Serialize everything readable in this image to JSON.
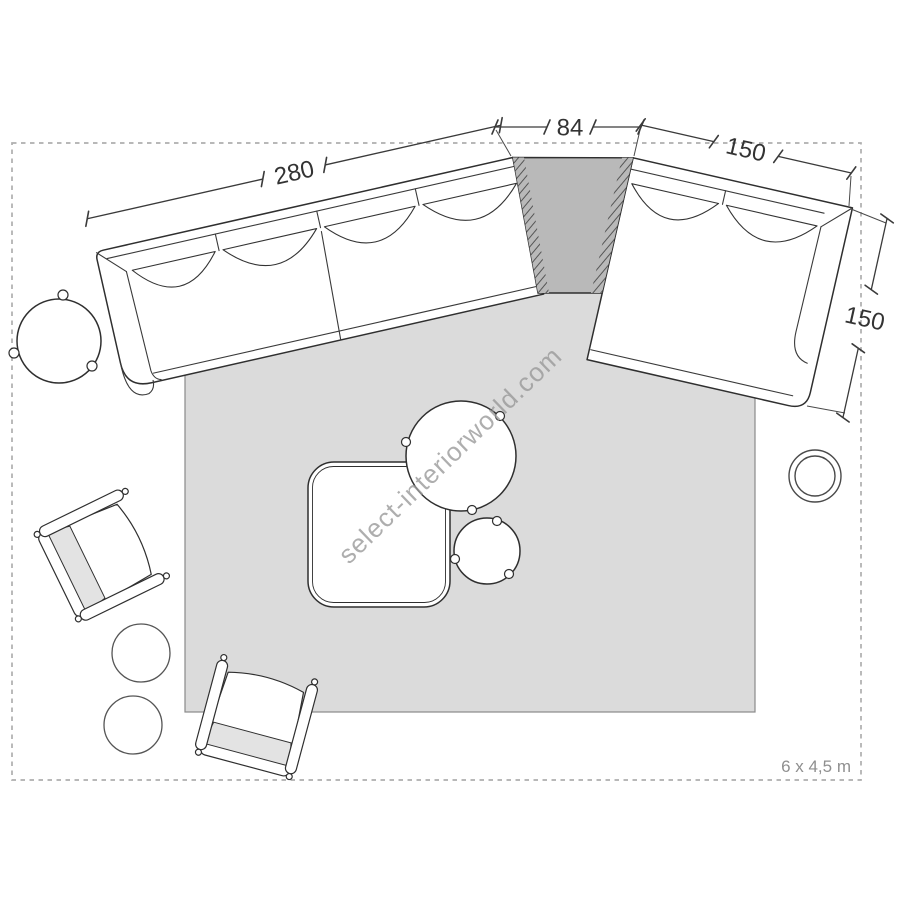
{
  "watermark": {
    "text": "select-interiorworld.com"
  },
  "room": {
    "size_label": "6 x 4,5 m"
  },
  "dimensions": {
    "sofa_left_width_cm": "280",
    "corner_element_width_cm": "84",
    "sofa_right_width_cm": "150",
    "sofa_right_depth_cm": "150"
  },
  "colors": {
    "rug": "#dbdbdb",
    "corner_element": "#b9b9b9",
    "outline": "#2f2f2f",
    "dashed_border": "#aeaeae",
    "dimension_text": "#333333",
    "muted_text": "#8f8f8f",
    "watermark": "#9a9a9a",
    "chair_cushion": "#e3e3e3"
  }
}
